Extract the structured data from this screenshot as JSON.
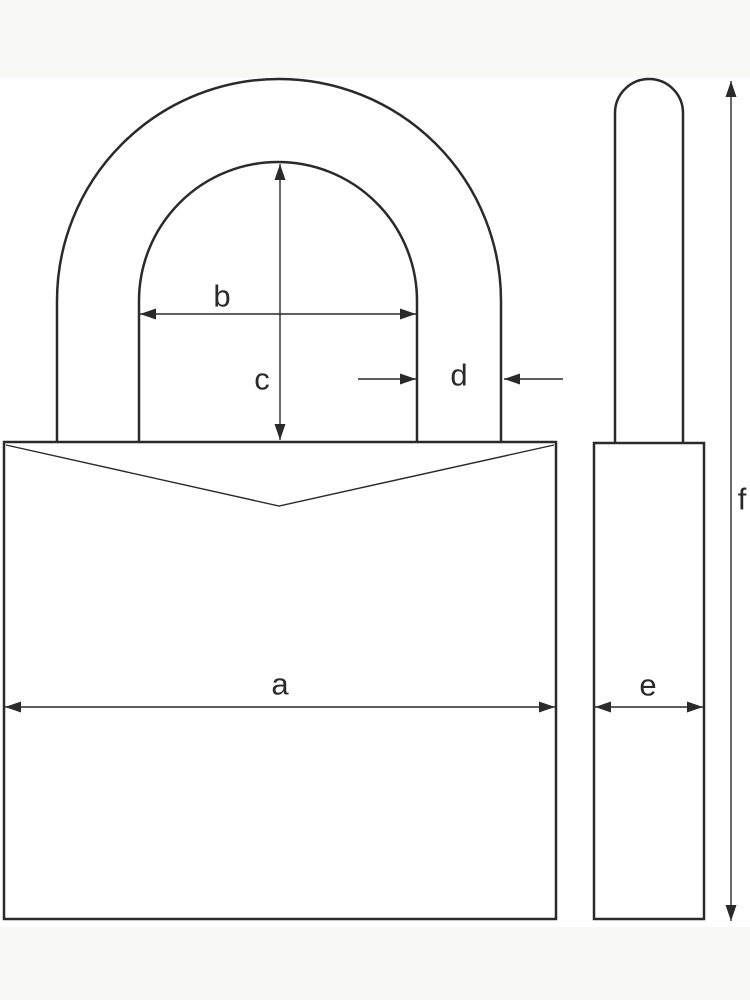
{
  "diagram": {
    "type": "technical-dimension-drawing",
    "subject": "padlock",
    "views": [
      {
        "id": "front-view",
        "description": "padlock front: body with shackle arch"
      },
      {
        "id": "side-view",
        "description": "padlock side: narrow body with shackle rod"
      }
    ],
    "colors": {
      "stroke": "#2a2a2a",
      "background": "#ffffff",
      "band": "#f8f8f5"
    },
    "bands": {
      "top": {
        "x": 0,
        "y": 0,
        "width": 750,
        "height": 78
      },
      "bottom": {
        "x": 0,
        "y": 927,
        "width": 750,
        "height": 73
      }
    },
    "dimensions": [
      {
        "id": "a",
        "label": "a",
        "orientation": "horizontal",
        "measures": "front body width",
        "segments": [
          {
            "x1": 5,
            "y1": 707,
            "x2": 555,
            "y2": 707,
            "heads": [
              "start",
              "end"
            ]
          }
        ],
        "label_pos": {
          "x": 280,
          "y": 684
        }
      },
      {
        "id": "b",
        "label": "b",
        "orientation": "horizontal",
        "measures": "shackle inner width",
        "segments": [
          {
            "x1": 140,
            "y1": 314,
            "x2": 416,
            "y2": 314,
            "heads": [
              "start",
              "end"
            ]
          }
        ],
        "label_pos": {
          "x": 222,
          "y": 296
        }
      },
      {
        "id": "c",
        "label": "c",
        "orientation": "vertical",
        "measures": "shackle inner height",
        "segments": [
          {
            "x1": 280,
            "y1": 164,
            "x2": 280,
            "y2": 440,
            "heads": [
              "start",
              "end"
            ]
          }
        ],
        "label_pos": {
          "x": 262,
          "y": 379
        }
      },
      {
        "id": "d",
        "label": "d",
        "orientation": "horizontal",
        "measures": "shackle thickness",
        "segments": [
          {
            "x1": 358,
            "y1": 379,
            "x2": 416,
            "y2": 379,
            "heads": [
              "end"
            ]
          },
          {
            "x1": 563,
            "y1": 379,
            "x2": 504,
            "y2": 379,
            "heads": [
              "end"
            ]
          }
        ],
        "label_pos": {
          "x": 459,
          "y": 375
        }
      },
      {
        "id": "e",
        "label": "e",
        "orientation": "horizontal",
        "measures": "body depth",
        "segments": [
          {
            "x1": 595,
            "y1": 707,
            "x2": 703,
            "y2": 707,
            "heads": [
              "start",
              "end"
            ]
          }
        ],
        "label_pos": {
          "x": 648,
          "y": 685
        }
      },
      {
        "id": "f",
        "label": "f",
        "orientation": "vertical",
        "measures": "overall height",
        "segments": [
          {
            "x1": 731,
            "y1": 81,
            "x2": 731,
            "y2": 921,
            "heads": [
              "start",
              "end"
            ]
          }
        ],
        "label_pos": {
          "x": 742,
          "y": 499
        }
      }
    ]
  }
}
